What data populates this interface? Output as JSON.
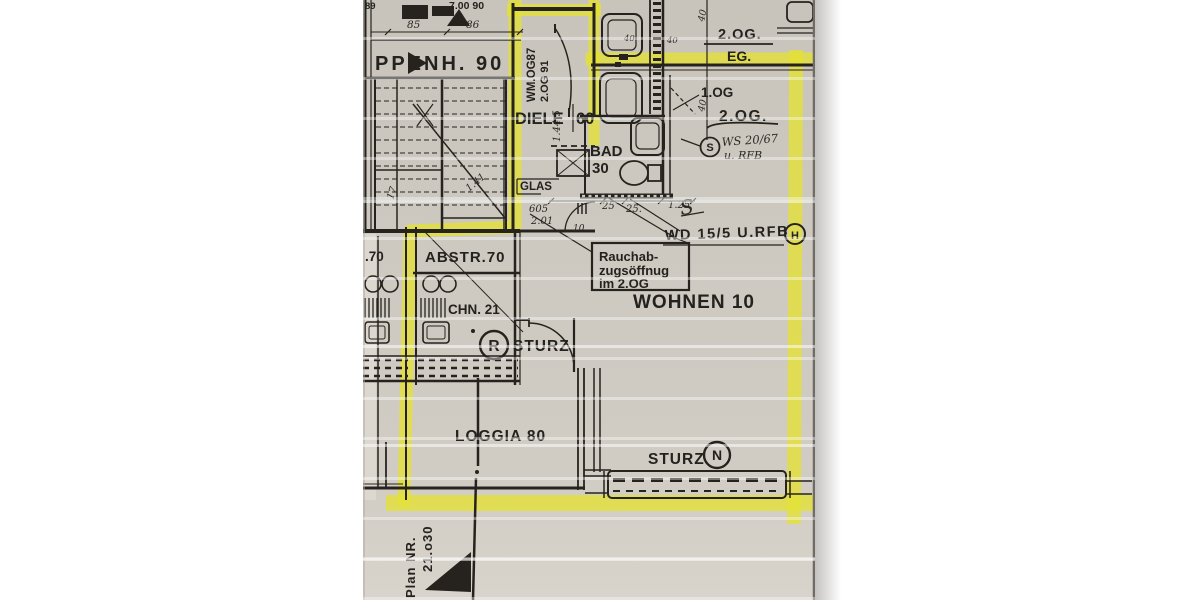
{
  "plan": {
    "rooms": {
      "treppenhaus": "PPENH. 90",
      "diele": "DIELE",
      "diele_area": "60",
      "bad": "BAD",
      "bad_area": "30",
      "abstellraum": "ABSTR.70",
      "neighbor_area": ".70",
      "kueche": "CHN. 21",
      "wohnen": "WOHNEN 10",
      "loggia": "LOGGIA 80",
      "glas": "GLAS"
    },
    "levels": {
      "og2_top": "2.OG.",
      "eg": "EG.",
      "og1": "1.OG",
      "og2_mid": "2.OG."
    },
    "annotations": {
      "rauch1": "Rauchab-",
      "rauch2": "zugsöffnug",
      "rauch3": "im 2.OG",
      "wd": "WD 15/5 U.RFB",
      "wd_marker": "H",
      "ws1": "WS 20/67",
      "ws2": "u. RFB",
      "s_marker": "S",
      "s_hand": "S",
      "sturz1": "STURZ",
      "sturz1_marker": "R",
      "sturz2": "STURZ",
      "sturz2_marker": "N"
    },
    "dims": {
      "top_left": "89",
      "top_width": "7.00 90",
      "d85": "85",
      "d86": "86",
      "wm": "WM.OG87",
      "og91": "2.OG 91",
      "v1445": "1.44,5",
      "d605": "605",
      "d201": "2.01",
      "d10": "10",
      "d25a": "25",
      "d25b": "25.",
      "d125": "1.25",
      "d17": "17",
      "d141": "1.41",
      "d40a": "40",
      "d40b": "40",
      "hand40a": "40",
      "hand40b": "40"
    },
    "plan_no": {
      "label": "Plan NR.",
      "value": "21.o30"
    },
    "colors": {
      "highlighter": "#e4e135",
      "paper": "#cbc7bf",
      "ink": "#26231e"
    }
  }
}
